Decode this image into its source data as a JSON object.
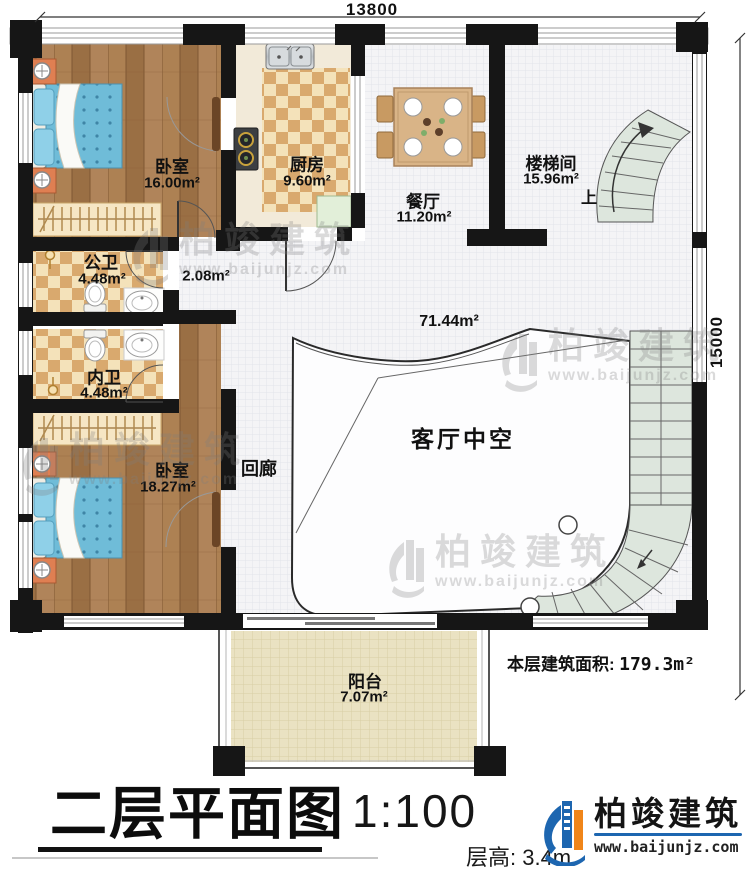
{
  "plan": {
    "dimensions": {
      "width_mm": "13800",
      "height_mm": "15000"
    },
    "rooms": {
      "bedroom1": {
        "name": "卧室",
        "area": "16.00m²"
      },
      "kitchen": {
        "name": "厨房",
        "area": "9.60m²"
      },
      "dining": {
        "name": "餐厅",
        "area": "11.20m²"
      },
      "stairwell": {
        "name": "楼梯间",
        "area": "15.96m²",
        "up": "上"
      },
      "bath_public": {
        "name": "公卫",
        "area": "4.48m²"
      },
      "hallway": {
        "area": "2.08m²"
      },
      "bath_ensuite": {
        "name": "内卫",
        "area": "4.48m²"
      },
      "bedroom2": {
        "name": "卧室",
        "area": "18.27m²"
      },
      "corridor": {
        "name": "回廊"
      },
      "void": {
        "name": "客厅中空",
        "area": "71.44m²"
      },
      "balcony": {
        "name": "阳台",
        "area": "7.07m²"
      }
    },
    "notes": {
      "floor_area_label": "本层建筑面积:",
      "floor_area_value": "179.3m²",
      "floor_height": "层高: 3.4m"
    }
  },
  "titleblock": {
    "title": "二层平面图",
    "scale": "1:100"
  },
  "brand": {
    "name": "柏竣建筑",
    "website": "www.baijunjz.com"
  },
  "watermark": {
    "name": "柏竣建筑",
    "website": "www.baijunjz.com"
  },
  "colors": {
    "wall": "#161616",
    "wood_floor": "#a6794b",
    "checker_dark": "#d9a96e",
    "checker_light": "#f4e2ba",
    "tile": "#f4f4f6",
    "stair_tread": "#dde6dd",
    "balcony_floor": "#eae2c2",
    "bed_blue": "#6fbcd8",
    "nightstand_orange": "#df7f52",
    "brand_blue": "#1d66b0",
    "brand_orange": "#f08519"
  }
}
